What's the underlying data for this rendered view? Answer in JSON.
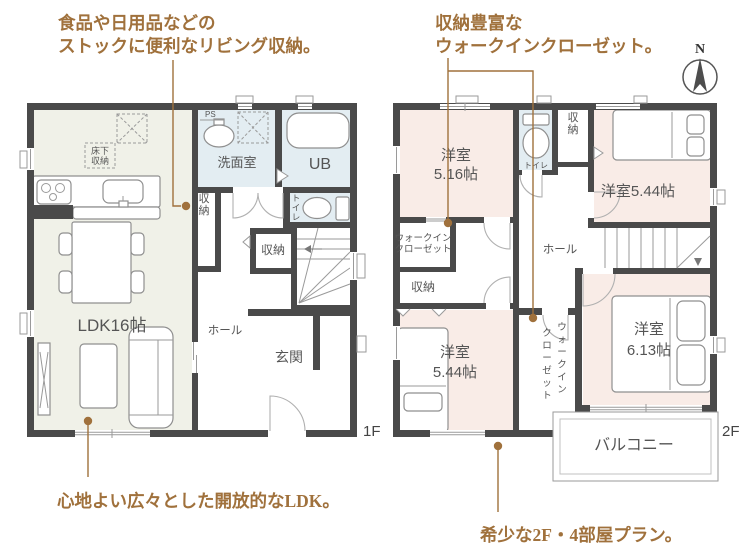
{
  "colors": {
    "wall": "#4a4a4a",
    "ldk_fill": "#f0f1e8",
    "bedroom_fill": "#f9ece7",
    "wet_fill": "#e3edf2",
    "annotation": "#a0713c",
    "label": "#555555"
  },
  "annotations": {
    "top_left_line1": "食品や日用品などの",
    "top_left_line2": "ストックに便利なリビング収納。",
    "top_right_line1": "収納豊富な",
    "top_right_line2": "ウォークインクローゼット。",
    "bottom_left": "心地よい広々とした開放的なLDK。",
    "bottom_right": "希少な2F・4部屋プラン。"
  },
  "compass": {
    "north": "N"
  },
  "floor1": {
    "label": "1F",
    "ldk": "LDK16帖",
    "washroom": "洗面室",
    "bath": "UB",
    "toilet": "トイレ",
    "storage_side": "収納",
    "storage_hall": "収納",
    "hall": "ホール",
    "entrance": "玄関",
    "underfloor1": "床下",
    "underfloor2": "収納",
    "ps": "PS"
  },
  "floor2": {
    "label": "2F",
    "bedroom1_name": "洋室",
    "bedroom1_size": "5.16帖",
    "bedroom2": "洋室5.44帖",
    "bedroom3_name": "洋室",
    "bedroom3_size": "5.44帖",
    "bedroom4_name": "洋室",
    "bedroom4_size": "6.13帖",
    "toilet": "トイレ",
    "storage_top": "収納",
    "storage_left": "収納",
    "wic_upper1": "ウォークイン",
    "wic_upper2": "クローゼット",
    "wic_center1": "ウォークイン",
    "wic_center2": "クローゼット",
    "hall": "ホール",
    "balcony": "バルコニー"
  }
}
